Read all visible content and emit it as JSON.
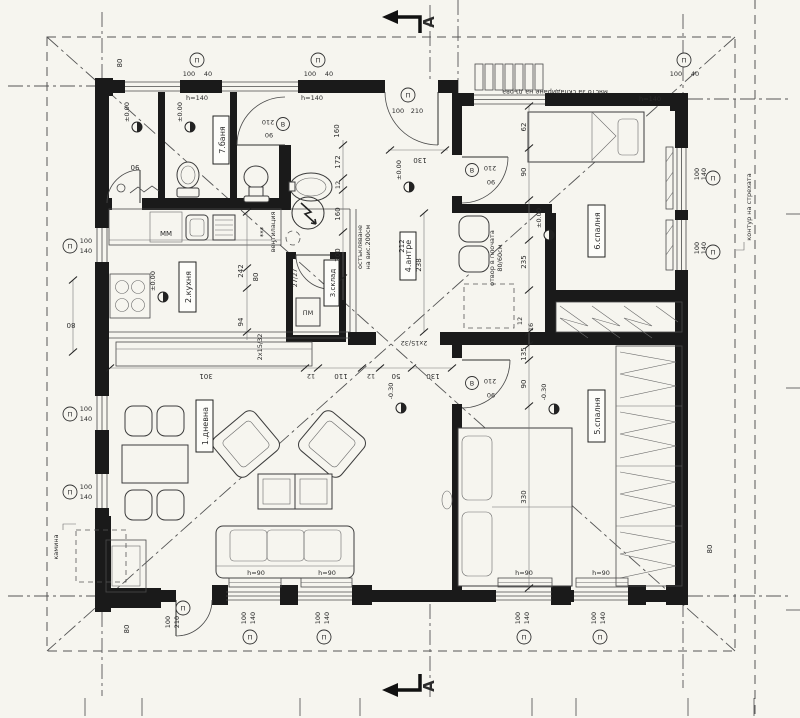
{
  "rooms": {
    "living": "1.дневна",
    "kitchen": "2.кухня",
    "storage": "3.склад",
    "hall": "4.антре",
    "bed5": "5.спалня",
    "bed6": "6.спалня",
    "bath": "7.баня"
  },
  "ann": {
    "firewood": "място за складиране на дърва",
    "eaves": "контур на стрехата",
    "fireplace": "камина",
    "glaz1": "остъкляване",
    "glaz2": "на вис.200см",
    "open1": "отвор в плочата",
    "open2": "80/60см",
    "vent": "вентилация",
    "stars": "***",
    "mm": "ММ",
    "pm": "ПМ",
    "steps": "2x15/32",
    "treads": "27/27",
    "h140": "h=140",
    "h90": "h=90",
    "section": "А"
  },
  "lv": {
    "zero": "±0.00",
    "m030": "-0.30"
  },
  "tg": {
    "P": "П",
    "B": "В",
    "n100": "100",
    "n140": "140",
    "n40": "40",
    "n210": "210",
    "n90": "90"
  },
  "dims": [
    "80",
    "90",
    "160",
    "172",
    "12",
    "160",
    "200",
    "212",
    "238",
    "130",
    "62",
    "90",
    "235",
    "12",
    "16",
    "135",
    "90",
    "330",
    "242",
    "80",
    "94",
    "301",
    "12",
    "110",
    "12",
    "50",
    "130",
    "80",
    "80",
    "80"
  ]
}
